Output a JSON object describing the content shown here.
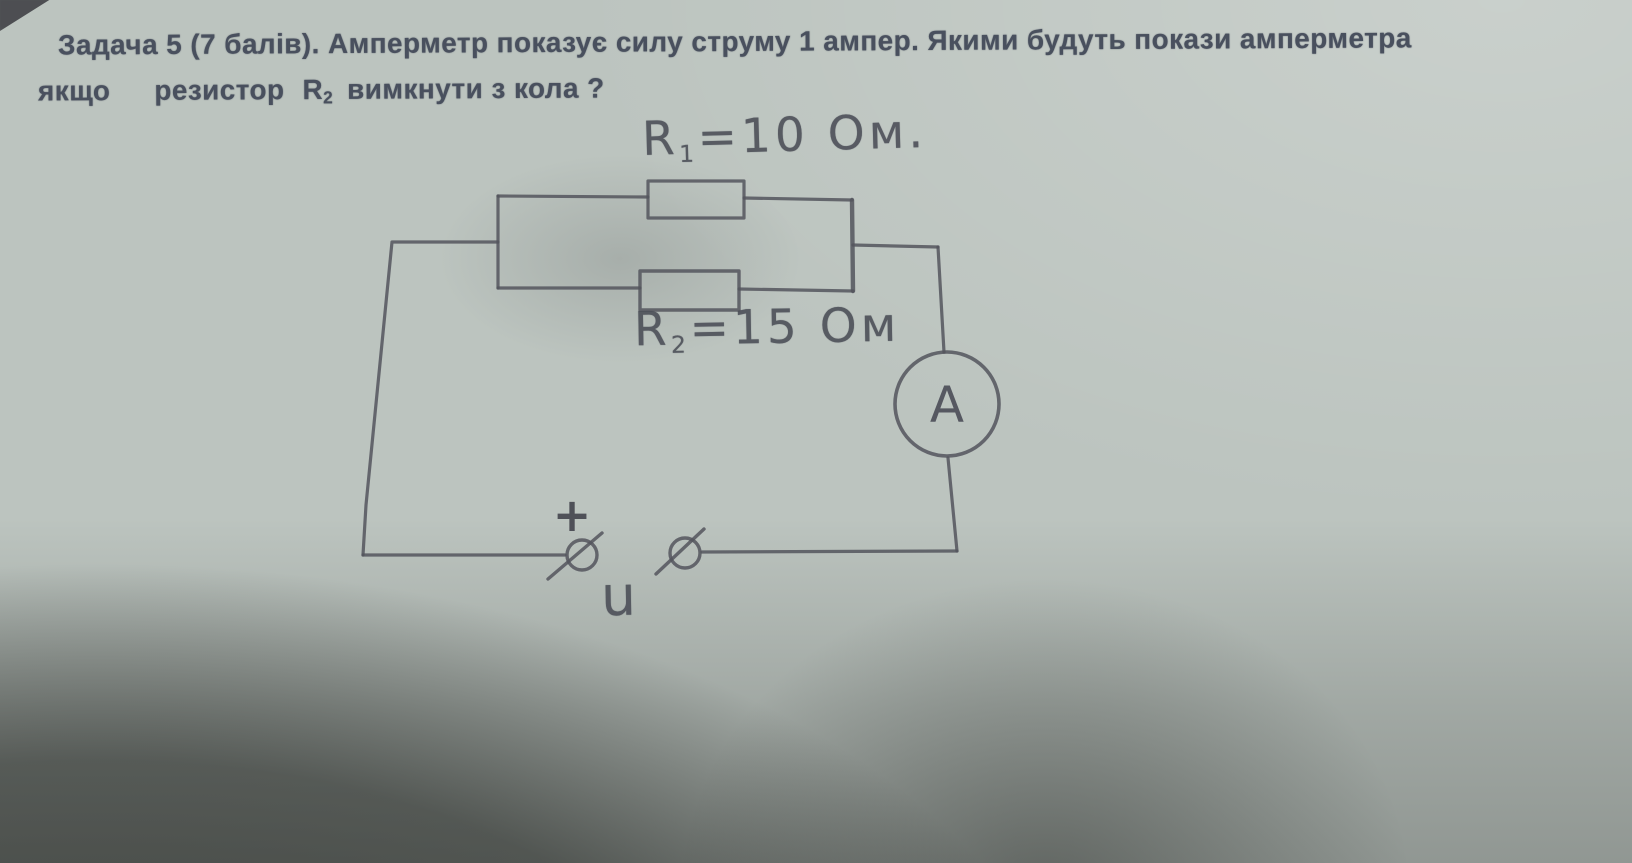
{
  "problem": {
    "line1": "Задача 5 (7 балів). Амперметр показує силу струму 1 ампер. Якими будуть покази амперметра",
    "line2_word1": "якщо",
    "line2_word2": "резистор",
    "line2_r_base": "R",
    "line2_r_sub": "2",
    "line2_rest": "вимкнути з кола ?"
  },
  "circuit": {
    "r1_base": "R",
    "r1_sub": "1",
    "r1_value": "=10 Ом.",
    "r2_base": "R",
    "r2_sub": "2",
    "r2_value": "=15 Ом",
    "ammeter_label": "A",
    "plus_label": "+",
    "voltage_label": "U"
  },
  "icons": {
    "ammeter": "circled-letter-A",
    "left_terminal": "circle-slash-terminal",
    "right_terminal": "circle-slash-terminal",
    "plus": "plus-sign"
  },
  "colors": {
    "paper": "#bcc4bf",
    "pencil": "#53555d",
    "printed_text": "#49505e",
    "shadow": "#5e605b"
  }
}
